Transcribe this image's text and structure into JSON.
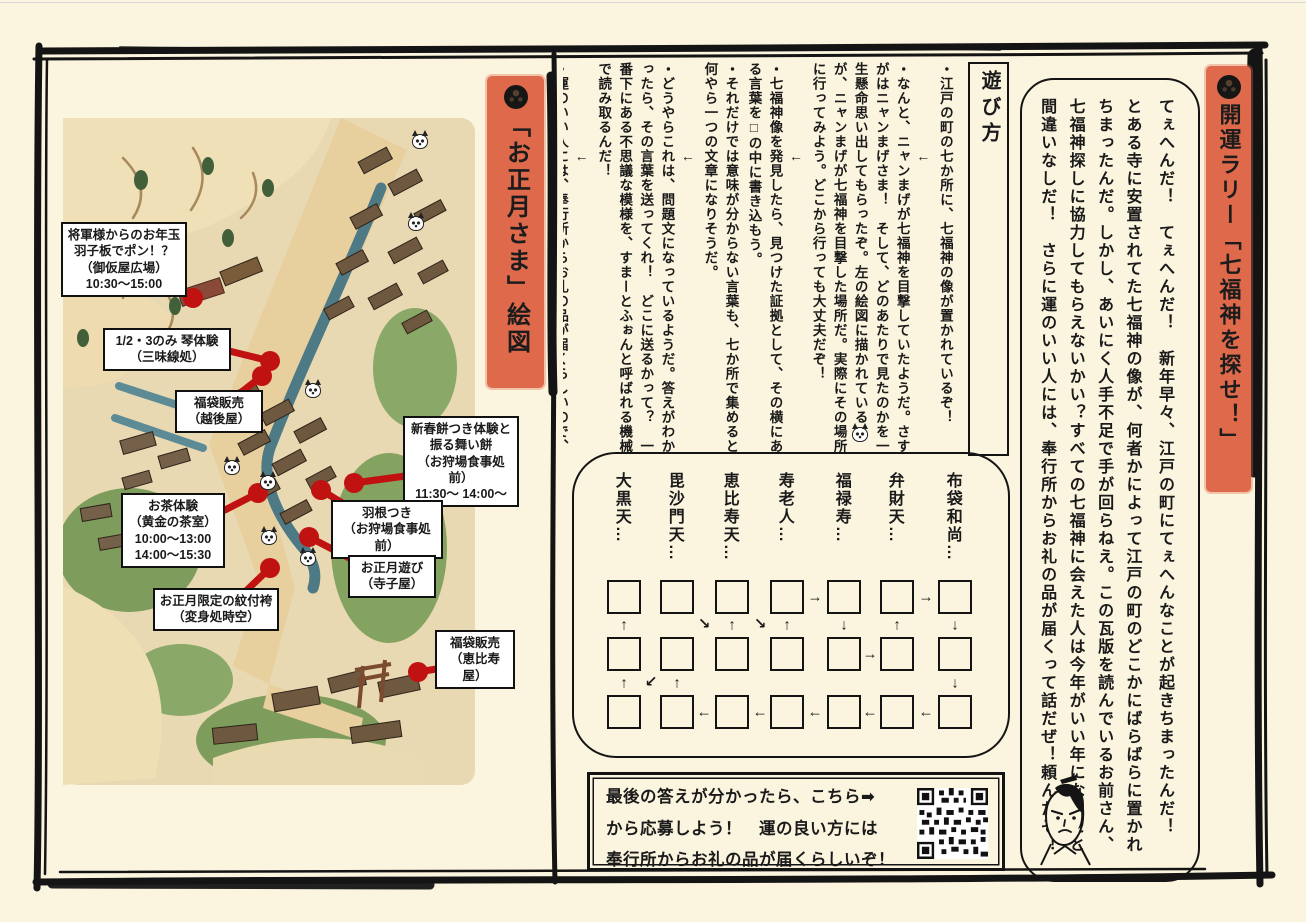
{
  "colors": {
    "page_background": "#FBF4DE",
    "banner_orange": "#DF6A4B",
    "marker_red": "#C11212",
    "ink_black": "#141414",
    "map_paper": "#E9D9B3"
  },
  "banners": {
    "rally": "開運ラリー「七福神を探せ！」",
    "map": "「お正月さま」絵図"
  },
  "intro": {
    "p1": "てぇへんだ！　てぇへんだ！　新年早々、江戸の町にてぇへんなことが起きちまったんだ！",
    "p2": "とある寺に安置されてた七福神の像が、何者かによって江戸の町のどこかにばらばらに置かれちまったんだ。しかし、あいにく人手不足で手が回らねえ。この瓦版を読んでいるお前さん、七福神探しに協力してもらえないかい？すべての七福神に会えた人は今年がいい年になること間違いなしだ！　さらに運のいい人には、奉行所からお礼の品が届くって話だぜ！頼んだぞ！"
  },
  "howto": {
    "title": "遊び方",
    "b1": "・江戸の町の七か所に、七福神の像が置かれているぞ！",
    "arrow": "←",
    "b2a": "・なんと、ニャンまげが七福神を目撃していたようだ。さすがはニャンまげさま！　そして、どのあたりで見たのかを一生懸命思い出してもらったぞ。左の絵図に描かれている",
    "b2b": "が、ニャンまげが七福神を目撃した場所だ。実際にその場所に行ってみよう。どこから行っても大丈夫だぞ！",
    "b3": "・七福神像を発見したら、見つけた証拠として、その横にある言葉を□の中に書き込もう。",
    "b4": "・それだけでは意味が分からない言葉も、七か所で集めると何やら一つの文章になりそうだ。",
    "b5": "・どうやらこれは、問題文になっているようだ。答えがわかったら、その言葉を送ってくれ！　どこに送るかって？　一番下にある不思議な模様を、すまーとふぉんと呼ばれる機械で読み取るんだ！",
    "b6": "・運のいい人には、奉行所からお礼の品が届くらしいので、送り先の住所も忘れずにな！"
  },
  "answer_grid": {
    "gods": [
      "大黒天…",
      "毘沙門天…",
      "恵比寿天…",
      "寿老人…",
      "福禄寿…",
      "弁財天…",
      "布袋和尚…"
    ],
    "rows": 3,
    "cols": 7,
    "arrows": [
      {
        "g": "→",
        "x": 241,
        "y": 143
      },
      {
        "g": "→",
        "x": 352,
        "y": 143
      },
      {
        "g": "↑",
        "x": 50,
        "y": 171
      },
      {
        "g": "↘",
        "x": 130,
        "y": 170
      },
      {
        "g": "↑",
        "x": 158,
        "y": 171
      },
      {
        "g": "↘",
        "x": 186,
        "y": 170
      },
      {
        "g": "↑",
        "x": 213,
        "y": 171
      },
      {
        "g": "↓",
        "x": 270,
        "y": 171
      },
      {
        "g": "↑",
        "x": 323,
        "y": 171
      },
      {
        "g": "↓",
        "x": 381,
        "y": 171
      },
      {
        "g": "→",
        "x": 296,
        "y": 200
      },
      {
        "g": "↑",
        "x": 50,
        "y": 229
      },
      {
        "g": "↙",
        "x": 77,
        "y": 228
      },
      {
        "g": "↑",
        "x": 103,
        "y": 229
      },
      {
        "g": "↓",
        "x": 381,
        "y": 229
      },
      {
        "g": "←",
        "x": 130,
        "y": 258
      },
      {
        "g": "←",
        "x": 186,
        "y": 258
      },
      {
        "g": "←",
        "x": 241,
        "y": 258
      },
      {
        "g": "←",
        "x": 296,
        "y": 258
      },
      {
        "g": "←",
        "x": 352,
        "y": 258
      }
    ]
  },
  "apply": {
    "text": "最後の答えが分かったら、こちら➡\nから応募しよう！　運の良い方には\n奉行所からお礼の品が届くらしいぞ！"
  },
  "map": {
    "callouts": [
      "将軍様からのお年玉\n羽子板でポン！？\n（御仮屋広場）\n10:30～15:00",
      "1/2・3のみ 琴体験\n（三味線処）",
      "福袋販売\n（越後屋）",
      "新春餅つき体験と\n振る舞い餅\n（お狩場食事処前）\n11:30～ 14:00～",
      "羽根つき\n（お狩場食事処前）",
      "お茶体験\n（黄金の茶室）\n10:00～13:00\n14:00～15:30",
      "お正月遊び\n（寺子屋）",
      "お正月限定の紋付袴\n（変身処時空）",
      "福袋販売\n（恵比寿屋）"
    ]
  }
}
